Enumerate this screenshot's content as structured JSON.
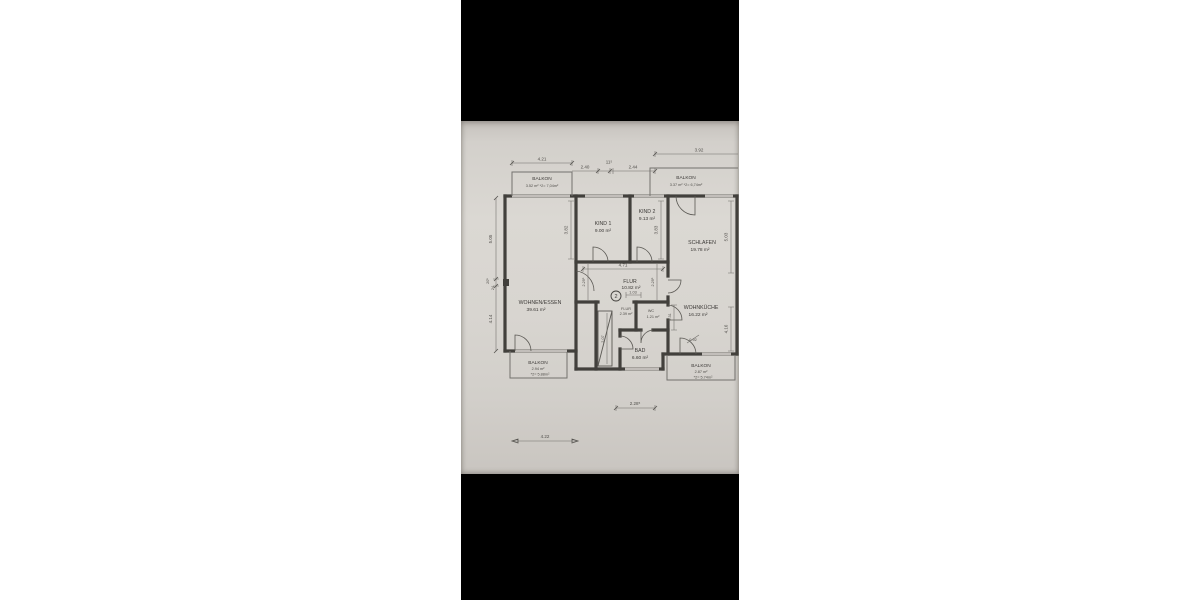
{
  "photo": {
    "description": "floor-plan-photo",
    "background_color": "#000000",
    "page_background": "#ffffff",
    "paper_color": "#d6d3ce",
    "ink_color": "#42403c"
  },
  "labels": {
    "wohnen": "WOHNEN/ESSEN",
    "wohnen_a": "39.61 m²",
    "kind1": "KIND 1",
    "kind1_a": "9.00 m²",
    "kind2": "KIND 2",
    "kind2_a": "9.13 m²",
    "schlafen": "SCHLAFEN",
    "schlafen_a": "19.78 m²",
    "flur": "FLUR",
    "flur_a": "10.82 m²",
    "flur2": "FLUR",
    "flur2_a": "2.39 m²",
    "wc": "WC",
    "wc_a": "1.21 m²",
    "kueche": "WOHNKÜCHE",
    "kueche_a": "16.22 m²",
    "bad": "BAD",
    "bad_a": "6.60 m²",
    "balkon_tl": "BALKON",
    "balkon_tl_a": "3.52 m²  *2= 7,04m²",
    "balkon_tr": "BALKON",
    "balkon_tr_a": "3.37 m²  *2= 6,74m²",
    "balkon_bl": "BALKON",
    "balkon_bl_a": "2.94 m²",
    "balkon_bl_b": "*2= 5.88m²",
    "balkon_br": "BALKON",
    "balkon_br_a": "2.87 m²",
    "balkon_br_b": "*2= 5.74m²",
    "marker": "2"
  },
  "dims": {
    "top1": "4.21",
    "top2": "2.40",
    "top3": "11⁵",
    "top4": "2.44",
    "top5": "3.92",
    "left1": "5.05",
    "left2": "20⁵",
    "left3": "24",
    "left4": "4.14",
    "kind1_h": "3.82",
    "kind2_h": "3.83",
    "schlafen_h": "5.03",
    "flur_w": "4.71",
    "flur_s": "1.03",
    "flur_hl": "2.29⁵",
    "flur_hr": "2.29⁵",
    "wc_h": "1.31",
    "kueche_h": "4.16",
    "corridor_h": "2.07",
    "door_w": "0.92",
    "bottom_mid": "2.28⁵",
    "bottom_left": "4.22"
  }
}
